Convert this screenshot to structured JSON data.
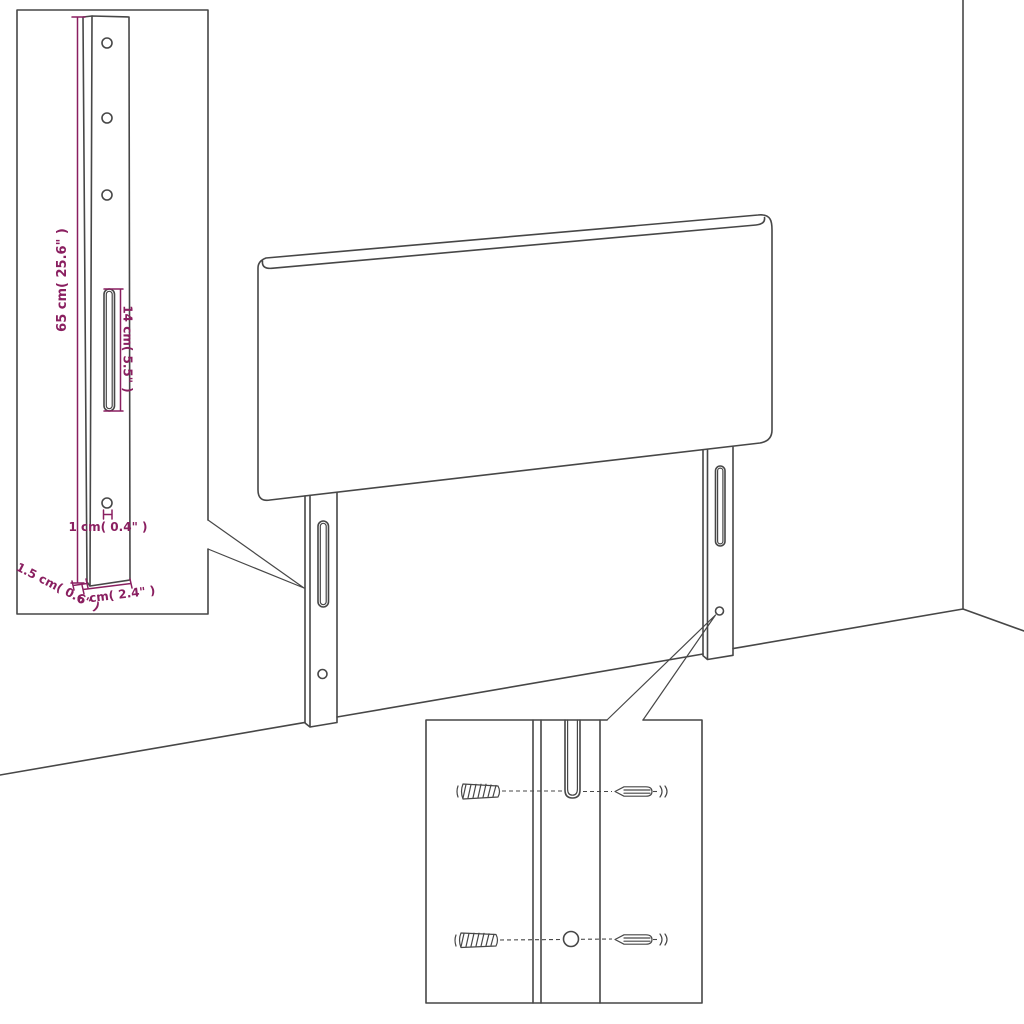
{
  "diagram": {
    "type": "furniture-assembly-technical-drawing",
    "subject": "headboard-with-mounting-legs",
    "colors": {
      "background": "#ffffff",
      "line": "#474747",
      "dimension": "#8a1f60"
    },
    "labels": {
      "bracket_height": "65 cm( 25.6\" )",
      "slot_length": "14 cm( 5.5\" )",
      "hole_diameter": "1 cm( 0.4\" )",
      "bracket_thickness": "1.5 cm( 0.6\" )",
      "bracket_width": "6 cm( 2.4\" )"
    }
  }
}
